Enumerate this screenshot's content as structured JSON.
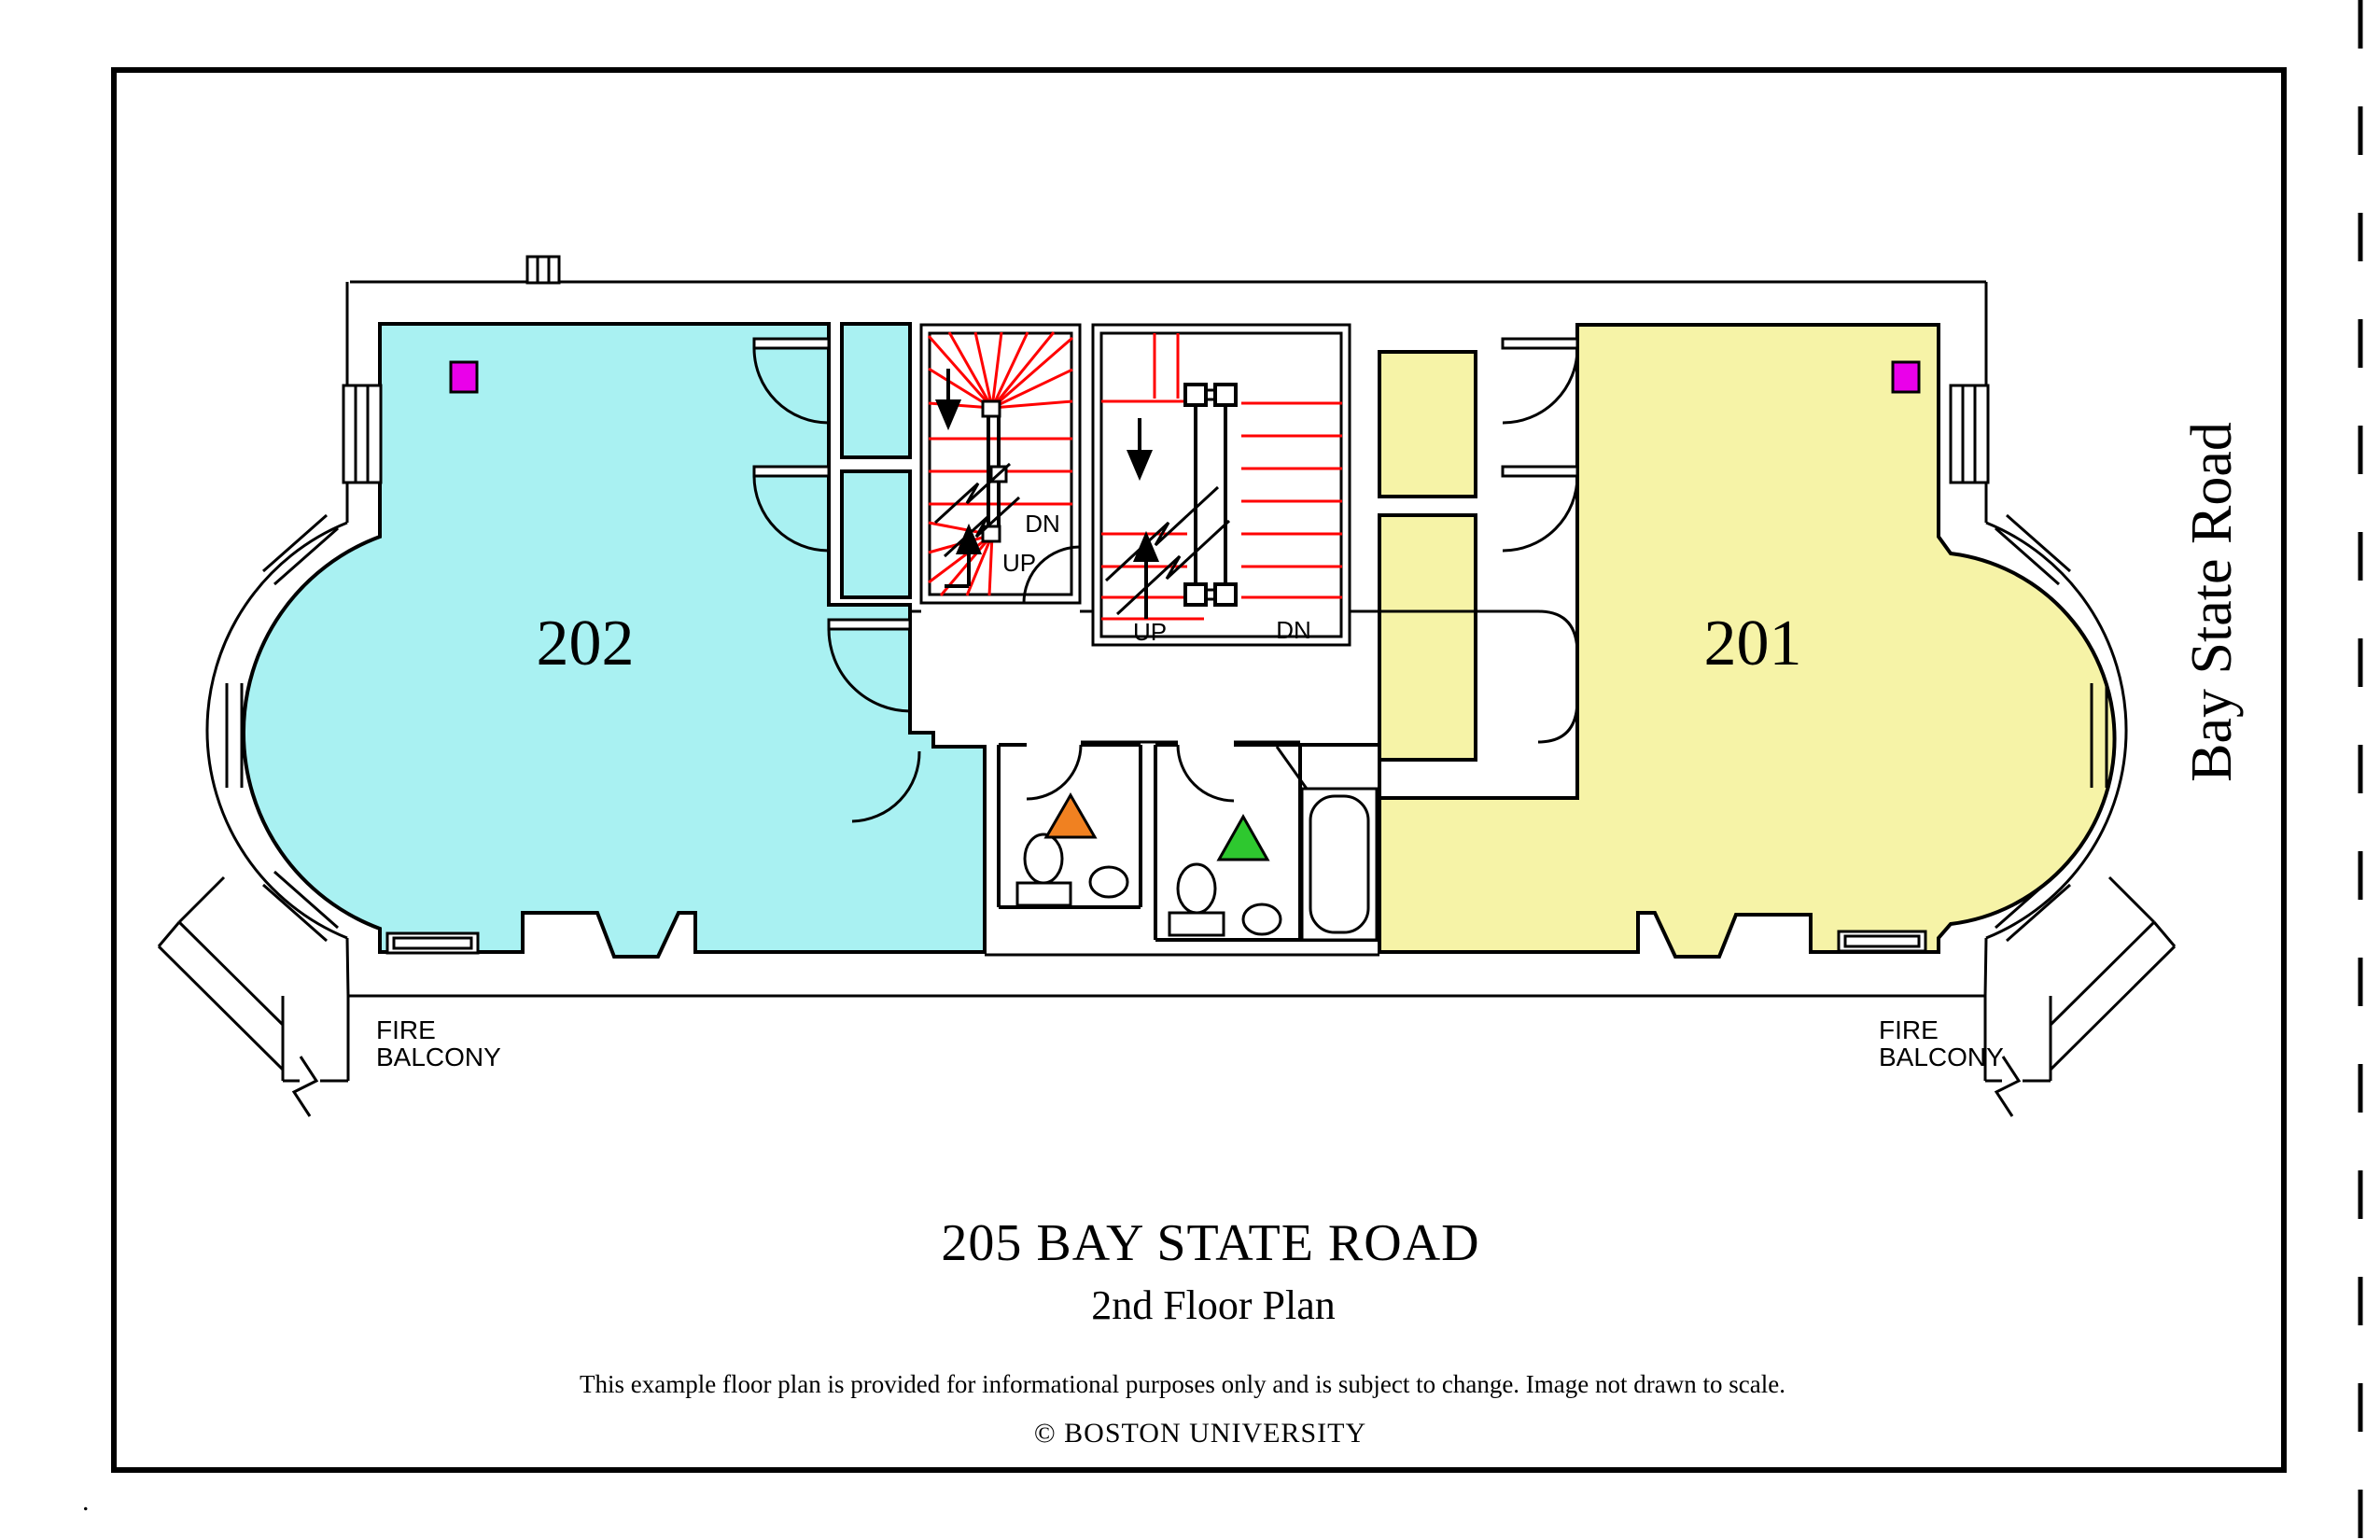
{
  "page": {
    "title": "205 BAY STATE ROAD",
    "subtitle": "2nd Floor Plan",
    "disclaimer": "This example floor plan is provided for informational purposes only and is subject to change. Image not drawn to scale.",
    "copyright": "© BOSTON UNIVERSITY",
    "street_label": "Bay State Road",
    "corner_dot": "."
  },
  "rooms": {
    "room202": {
      "label": "202"
    },
    "room201": {
      "label": "201"
    }
  },
  "stairs": {
    "left": {
      "dn": "DN",
      "up": "UP"
    },
    "right": {
      "up": "UP",
      "dn": "DN"
    }
  },
  "balconies": {
    "left": {
      "line1": "FIRE",
      "line2": "BALCONY"
    },
    "right": {
      "line1": "FIRE",
      "line2": "BALCONY"
    }
  },
  "markers": {
    "room202_square": "magenta-square-marker",
    "room201_square": "magenta-square-marker",
    "bath_left_triangle": "orange-triangle-marker",
    "bath_right_triangle": "green-triangle-marker"
  },
  "colors": {
    "room202_fill": "#a9f1f2",
    "room201_fill": "#f6f3a7",
    "marker_magenta": "#ea00ea",
    "marker_orange": "#f08121",
    "marker_green": "#2ec82f",
    "stair_red": "#ff0000",
    "wall_black": "#000000"
  }
}
